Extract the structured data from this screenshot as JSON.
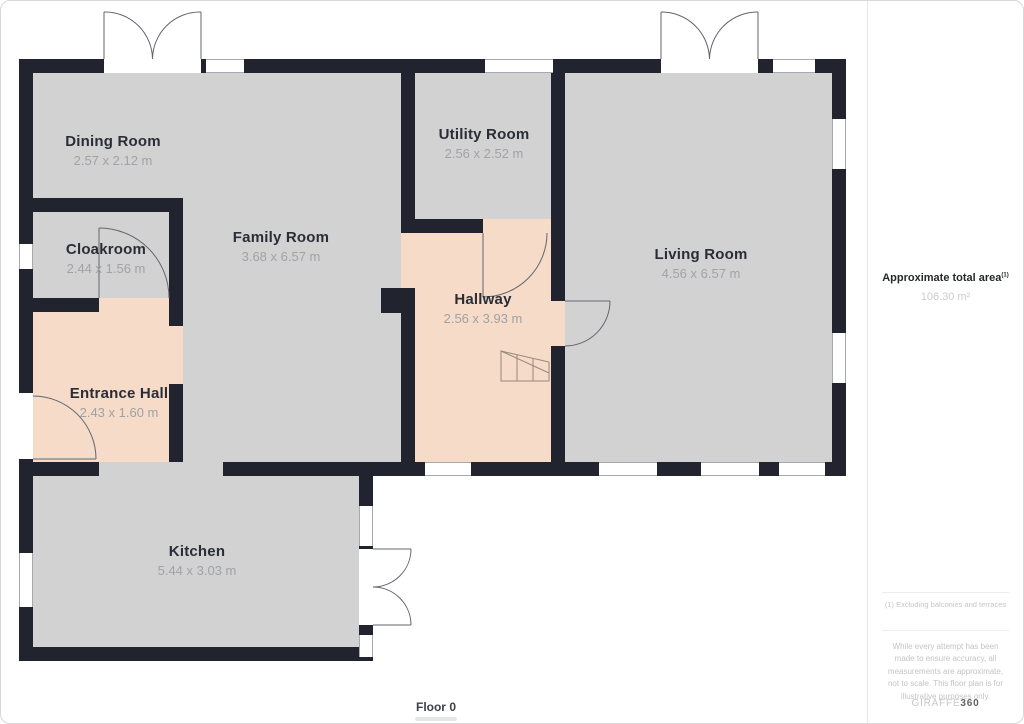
{
  "floor": {
    "label": "Floor 0"
  },
  "rooms": [
    {
      "name": "Dining Room",
      "dims": "2.57 x 2.12 m"
    },
    {
      "name": "Utility Room",
      "dims": "2.56 x 2.52 m"
    },
    {
      "name": "Living Room",
      "dims": "4.56 x 6.57 m"
    },
    {
      "name": "Cloakroom",
      "dims": "2.44 x 1.56 m"
    },
    {
      "name": "Family Room",
      "dims": "3.68 x 6.57 m"
    },
    {
      "name": "Hallway",
      "dims": "2.56 x 3.93 m"
    },
    {
      "name": "Entrance Hall",
      "dims": "2.43 x 1.60 m"
    },
    {
      "name": "Kitchen",
      "dims": "5.44 x 3.03 m"
    }
  ],
  "sidebar": {
    "total_area_label": "Approximate total area",
    "total_area_superscript": "(1)",
    "total_area_value": "106.30 m²",
    "footnote": "(1) Excluding balconies and terraces",
    "disclaimer": "While every attempt has been made to ensure accuracy, all measurements are approximate, not to scale. This floor plan is for illustrative purposes only.",
    "brand": {
      "name": "GIRAFFE",
      "suffix": "360"
    }
  },
  "colors": {
    "wall": "#21242e",
    "floor_gray": "#d2d2d3",
    "floor_peach": "#f5dbc8",
    "accent_text": "#2b2d36"
  }
}
